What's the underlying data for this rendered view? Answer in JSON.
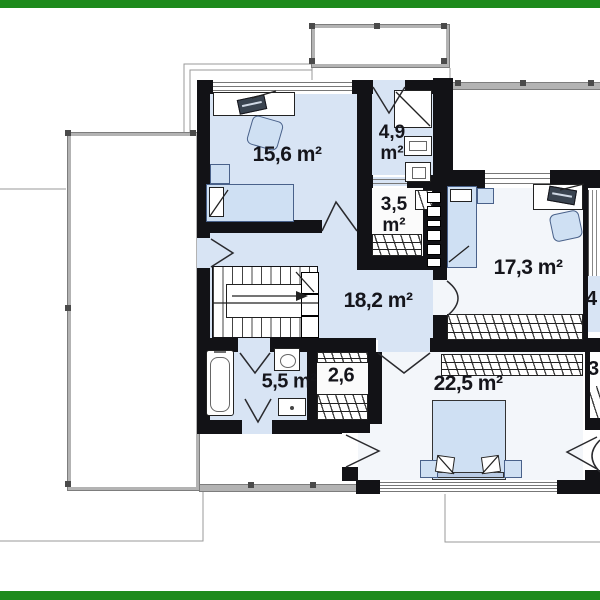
{
  "document": {
    "kind": "architectural floor plan, upper storey",
    "canvas": {
      "width": 600,
      "height": 600
    }
  },
  "floor_plan": {
    "rooms": [
      {
        "id": "bedroom-upper-left",
        "area_label": "15,6 m²"
      },
      {
        "id": "bathroom-upper",
        "area_value": "4,9",
        "area_unit": "m²"
      },
      {
        "id": "wardrobe-upper",
        "area_value": "3,5",
        "area_unit": "m²"
      },
      {
        "id": "bedroom-right",
        "area_label": "17,3 m²"
      },
      {
        "id": "hall-landing",
        "area_label": "18,2 m²"
      },
      {
        "id": "bathroom-lower",
        "area_label": "5,5 m²"
      },
      {
        "id": "closet-lower",
        "area_label": "2,6"
      },
      {
        "id": "bedroom-master",
        "area_label": "22,5 m²"
      }
    ],
    "edge_fragments": [
      {
        "id": "right-edge-top-fragment",
        "text": "4"
      },
      {
        "id": "right-edge-bottom-fragment",
        "text": "3"
      }
    ]
  },
  "colors": {
    "accent_green": "#1e8a1c",
    "wall": "#121216",
    "floor_blue": "#d8e4f4",
    "floor_pale": "#f3f6fa",
    "floor_white": "#fbfbfb",
    "furniture_blue": "#cfe0f3",
    "railing_gray": "#b3b3b3",
    "line_gray": "#8f8f8f",
    "label_text": "#15151b"
  }
}
